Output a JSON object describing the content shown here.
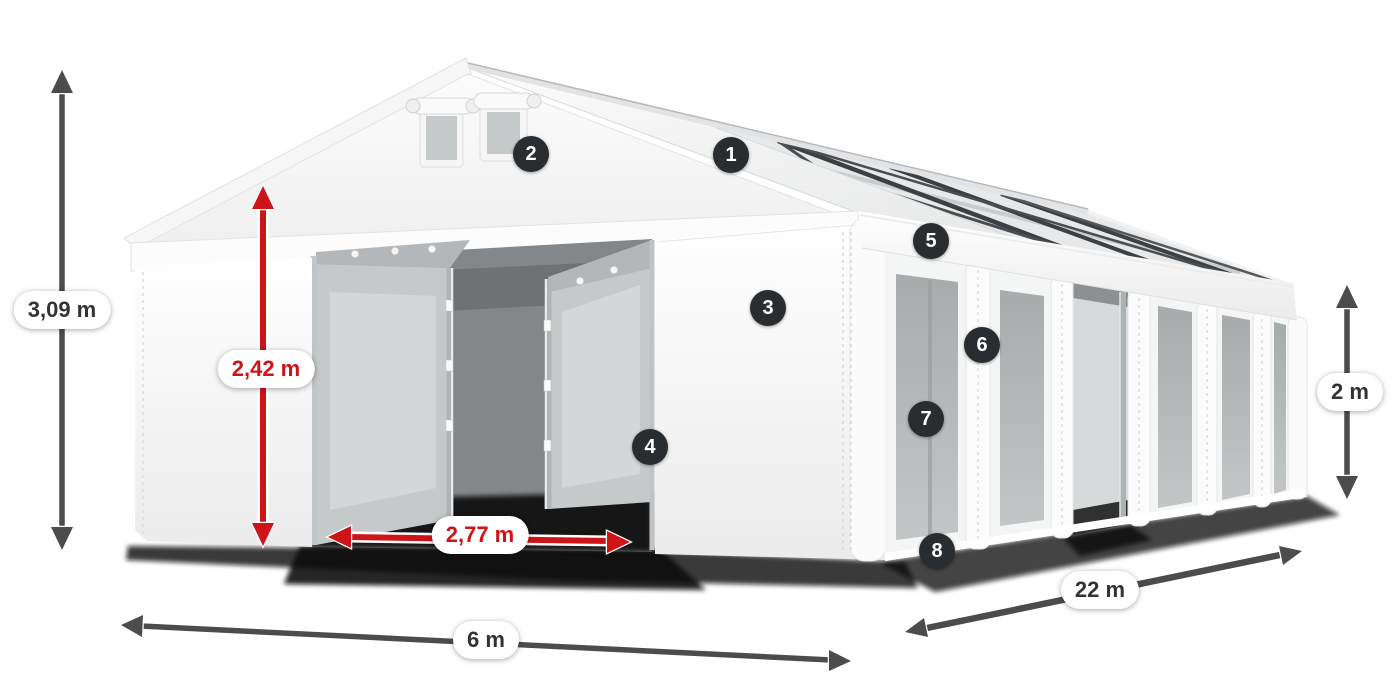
{
  "badges": [
    {
      "number": "1"
    },
    {
      "number": "2"
    },
    {
      "number": "3"
    },
    {
      "number": "4"
    },
    {
      "number": "5"
    },
    {
      "number": "6"
    },
    {
      "number": "7"
    },
    {
      "number": "8"
    }
  ],
  "dimensions": [
    {
      "id": "total-height",
      "text": "3,09 m",
      "style": "dark"
    },
    {
      "id": "door-height",
      "text": "2,42 m",
      "style": "red"
    },
    {
      "id": "door-width",
      "text": "2,77 m",
      "style": "red"
    },
    {
      "id": "gable-width",
      "text": "6 m",
      "style": "dark"
    },
    {
      "id": "length",
      "text": "22 m",
      "style": "dark"
    },
    {
      "id": "side-height",
      "text": "2 m",
      "style": "dark"
    }
  ],
  "colors": {
    "dimension_red": "#cf1418",
    "arrow_dark": "#4c4c4c",
    "badge_background": "#2a2d30",
    "label_background": "#ffffff",
    "label_text_dark": "#333333",
    "tent_white": "#ffffff",
    "window_gray": "#aeb2b3",
    "frame_dark": "#3d4043"
  }
}
